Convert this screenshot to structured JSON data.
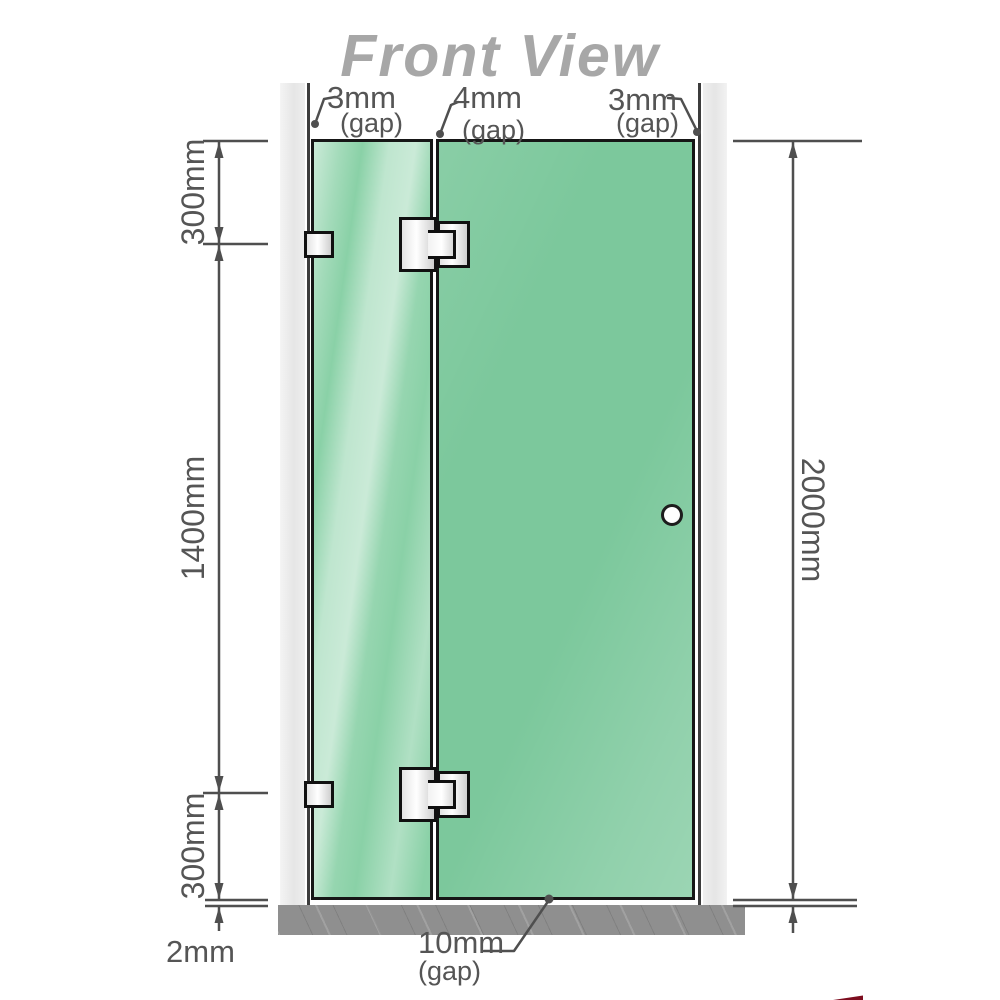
{
  "title": "Front View",
  "gaps": {
    "left": {
      "value": "3mm",
      "label": "(gap)"
    },
    "middle": {
      "value": "4mm",
      "label": "(gap)"
    },
    "right": {
      "value": "3mm",
      "label": "(gap)"
    }
  },
  "dimensions": {
    "left_top": "300mm",
    "left_middle": "1400mm",
    "left_bottom": "300mm",
    "right_height": "2000mm",
    "bottom_left": "2mm",
    "bottom_gap_value": "10mm",
    "bottom_gap_label": "(gap)"
  },
  "colors": {
    "glass_green": "#8ad1a7",
    "glass_green_dark": "#7cc89c",
    "wall_gray": "#ebebeb",
    "floor_gray": "#8f8f8f",
    "dimension_gray": "#555555",
    "title_gray": "#a7a7a7",
    "accent_red": "#7d0d1f"
  }
}
